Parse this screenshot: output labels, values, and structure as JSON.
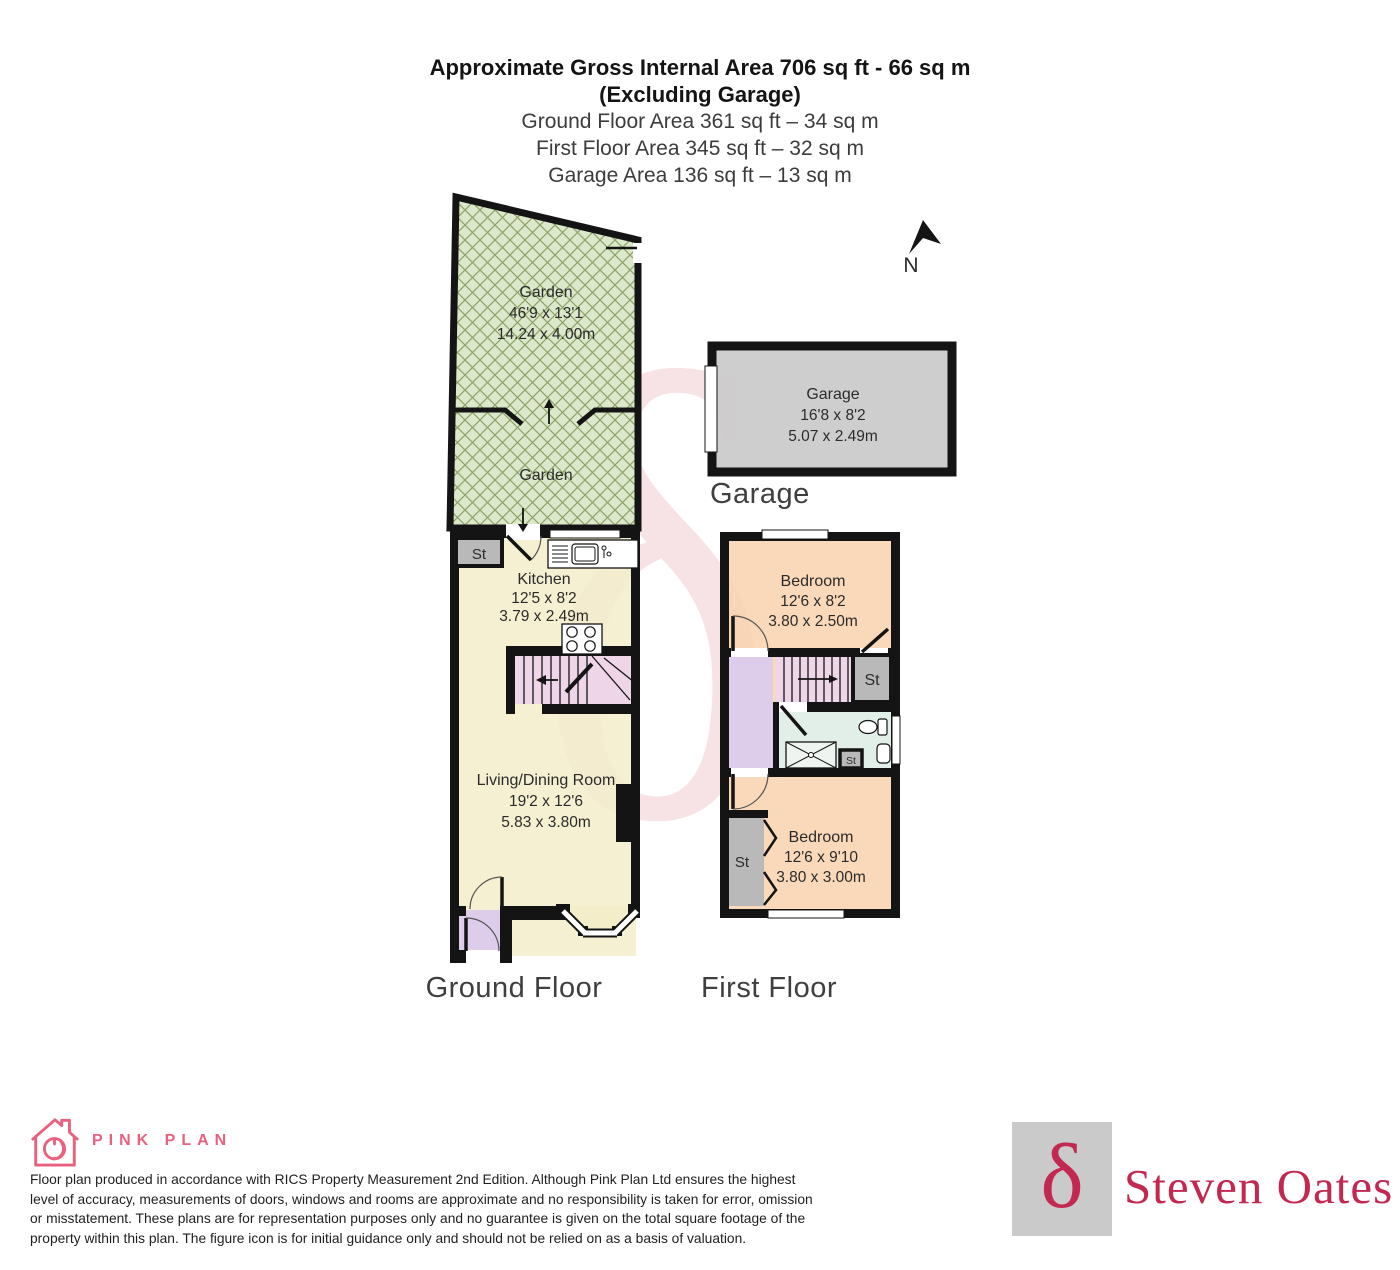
{
  "header": {
    "line1": "Approximate Gross Internal Area 706 sq ft - 66 sq m",
    "line2": "(Excluding Garage)",
    "line3": "Ground Floor Area 361 sq ft – 34 sq m",
    "line4": "First Floor Area 345 sq ft – 32 sq m",
    "line5": "Garage Area 136 sq ft – 13 sq m"
  },
  "compass": {
    "label": "N"
  },
  "rooms": {
    "garden_upper": {
      "name": "Garden",
      "imperial": "46'9 x 13'1",
      "metric": "14.24 x 4.00m"
    },
    "garden_lower": {
      "name": "Garden"
    },
    "garage": {
      "name": "Garage",
      "imperial": "16'8 x 8'2",
      "metric": "5.07 x 2.49m"
    },
    "kitchen": {
      "name": "Kitchen",
      "imperial": "12'5 x 8'2",
      "metric": "3.79 x 2.49m"
    },
    "living_dining": {
      "name": "Living/Dining Room",
      "imperial": "19'2 x 12'6",
      "metric": "5.83 x 3.80m"
    },
    "bedroom_front": {
      "name": "Bedroom",
      "imperial": "12'6 x 8'2",
      "metric": "3.80 x 2.50m"
    },
    "bedroom_back": {
      "name": "Bedroom",
      "imperial": "12'6 x 9'10",
      "metric": "3.80 x 3.00m"
    },
    "storage": "St"
  },
  "floor_titles": {
    "ground": "Ground Floor",
    "first": "First Floor",
    "garage": "Garage"
  },
  "footer": {
    "brand_name": "PINK PLAN",
    "disclaimer_lines": [
      "Floor plan produced in accordance with RICS Property Measurement 2nd Edition. Although Pink Plan Ltd ensures the highest",
      "level of accuracy, measurements of doors, windows and rooms are approximate and no responsibility is taken for error, omission",
      "or misstatement. These plans are for representation purposes only and no guarantee is given on the total square footage of the",
      "property within this plan. The figure icon is for initial guidance only and should not be relied on as a basis of valuation."
    ],
    "agent_name": "Steven Oates",
    "agent_symbol": "δ",
    "watermark_symbol": "δ"
  },
  "colors": {
    "garden": "#dce8cb",
    "garden_hatch": "#8da266",
    "floor_cream": "#f3edca",
    "bedroom_peach": "#f8d3ae",
    "stairs_pink": "#eed5e7",
    "hall_lavender": "#ddcdea",
    "bathroom_green": "#e2eee8",
    "storage_grey": "#b9b9b9",
    "garage_grey": "#c9c9c9",
    "wall_black": "#141414",
    "brand_pink": "#e8617e",
    "agent_red": "#c22850",
    "watermark_pink": "#f7e3e6"
  }
}
